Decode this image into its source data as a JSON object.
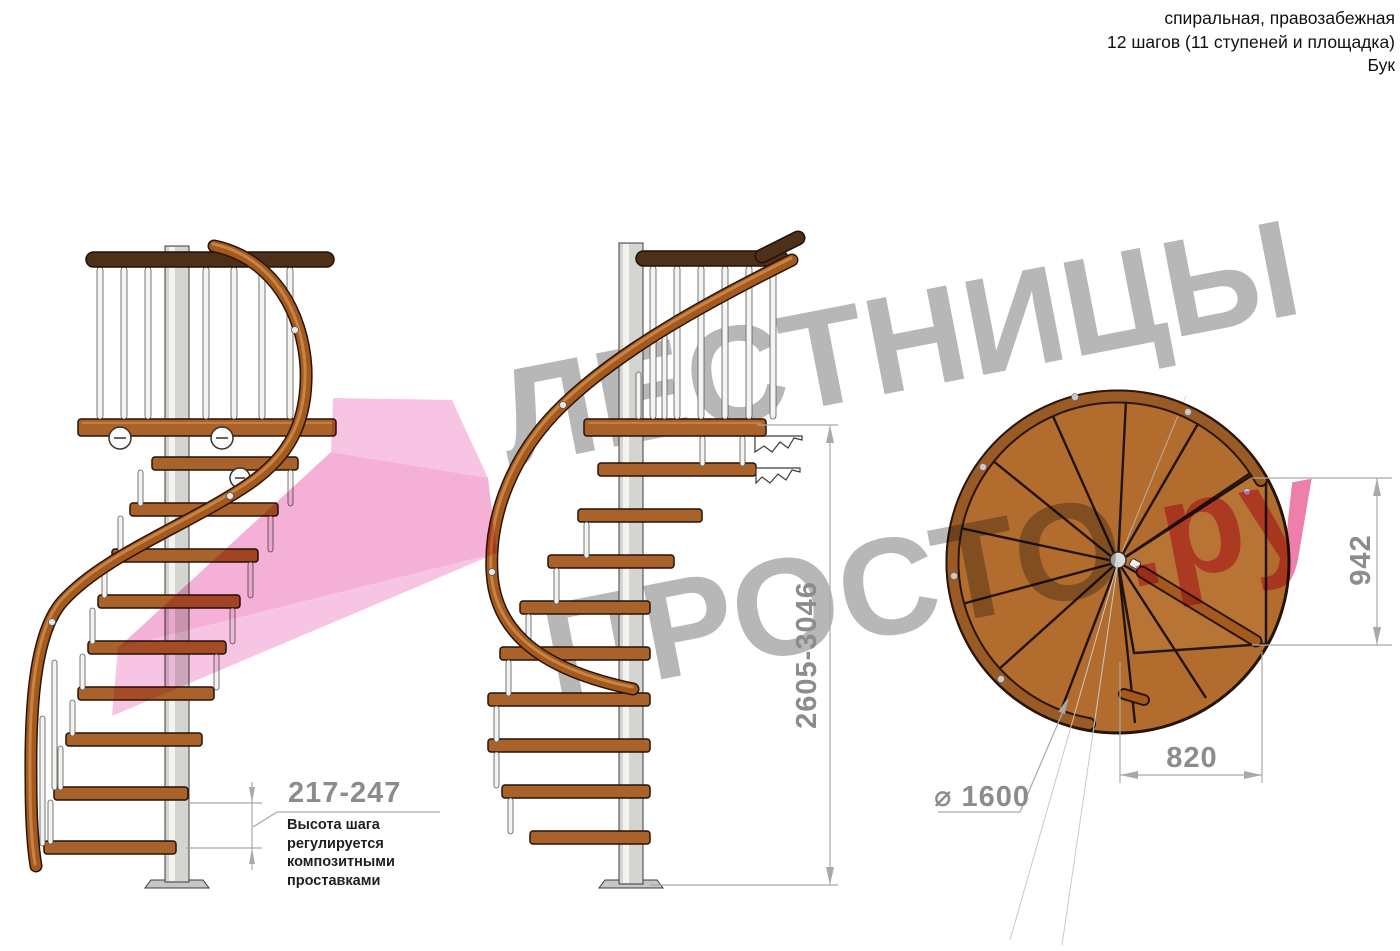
{
  "header": {
    "line1": "спиральная, правозабежная",
    "line2": "12 шагов (11 ступеней и площадка)",
    "line3": "Бук"
  },
  "watermark": {
    "line1": "ЛЕСТНИЦЫ",
    "line2_gray": "ПРОСТО",
    "line2_pink": ".ру",
    "gray_color": "#b7b7b7",
    "pink_color": "#ee7fab",
    "arrow_pink_light": "#f6bfe0",
    "arrow_pink_mid": "#f3a8d2"
  },
  "dimensions": {
    "total_height": "2605-3046",
    "step_height": "217-247",
    "platform_depth": "942",
    "platform_width": "820",
    "diameter": "⌀ 1600"
  },
  "annotation": {
    "line1": "Высота шага",
    "line2": "регулируется",
    "line3": "композитными",
    "line4": "проставками"
  },
  "drawing_colors": {
    "tread_wood": "#a8622a",
    "handrail_wood": "#a4591f",
    "dark_top_rail": "#4e3019",
    "steel_pole": "#d4d4d0",
    "dimension_gray": "#a9a9a9",
    "label_gray": "#8c8c8c"
  }
}
